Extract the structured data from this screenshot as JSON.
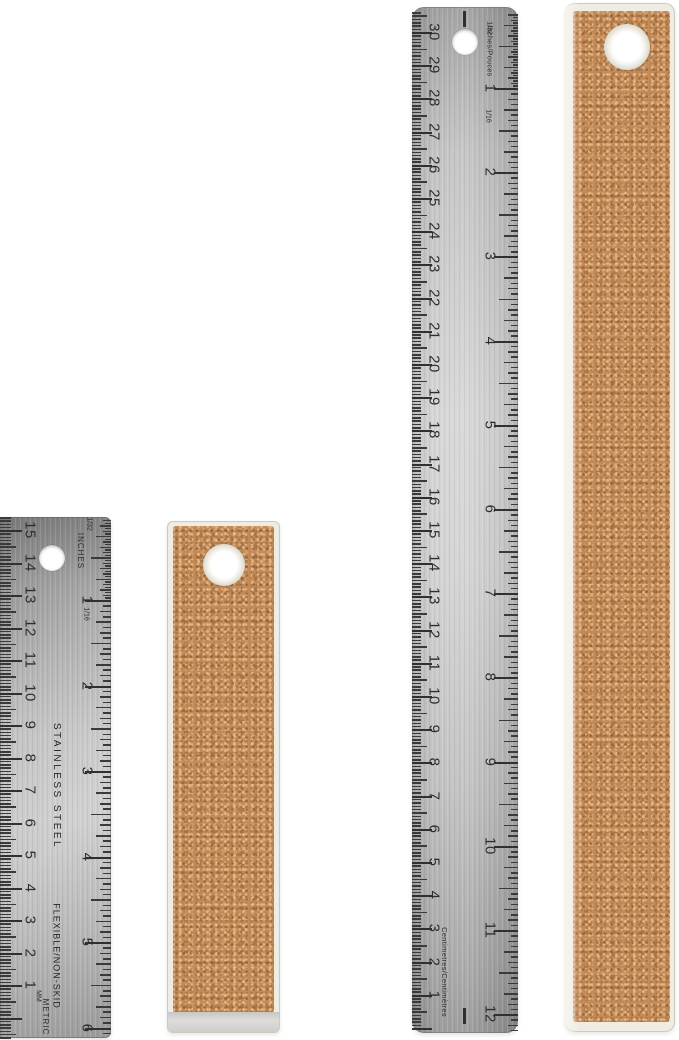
{
  "colors": {
    "background": "#ffffff",
    "steel_mid": "#cfcfcf",
    "steel_edge": "#9a9a9a",
    "markings": "#2e2e2e",
    "cork": "#c28a58",
    "cork_border": "#efece4"
  },
  "short_steel_ruler": {
    "cm_numbers": [
      "15",
      "14",
      "13",
      "12",
      "11",
      "10",
      "9",
      "8",
      "7",
      "6",
      "5",
      "4",
      "3",
      "2",
      "1"
    ],
    "inch_numbers": [
      "1",
      "2",
      "3",
      "4",
      "5",
      "6"
    ],
    "labels": {
      "top_fraction": "1/32",
      "inch_unit": "INCHES",
      "inch_fraction": "1/16",
      "mm": "MM",
      "metric": "METRIC",
      "material": "STAINLESS STEEL",
      "feature": "FLEXIBLE/NON-SKID"
    }
  },
  "long_steel_ruler": {
    "cm_numbers": [
      "30",
      "29",
      "28",
      "27",
      "26",
      "25",
      "24",
      "23",
      "22",
      "21",
      "20",
      "19",
      "18",
      "17",
      "16",
      "15",
      "14",
      "13",
      "12",
      "11",
      "10",
      "9",
      "8",
      "7",
      "6",
      "5",
      "4",
      "3",
      "2",
      "1"
    ],
    "inch_numbers": [
      "1",
      "2",
      "3",
      "4",
      "5",
      "6",
      "7",
      "8",
      "9",
      "10",
      "11",
      "12"
    ],
    "labels": {
      "top_fraction": "1/32",
      "inch_unit": "Inches/Pouces",
      "inch_fraction": "1/16",
      "cm_unit": "Centimetres/Centimètres"
    }
  }
}
